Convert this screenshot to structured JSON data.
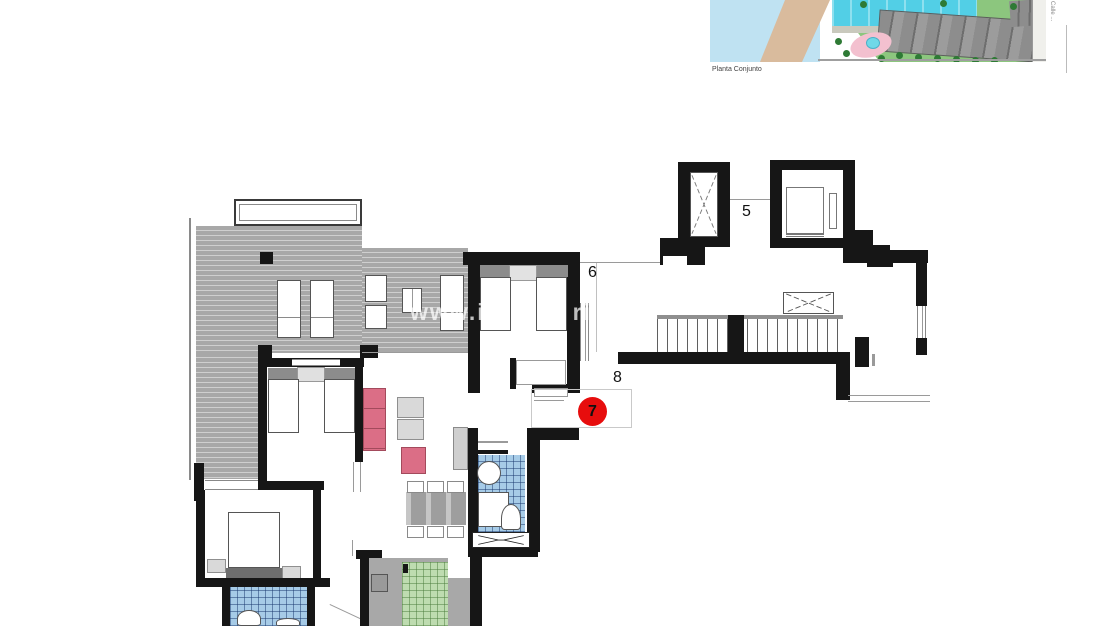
{
  "labels": {
    "unit5": "5",
    "unit6": "6",
    "unit8": "8",
    "badge": "7"
  },
  "watermark": "www.iw        ri",
  "site_plan": {
    "caption": "Planta Conjunto",
    "street": "Calle ..."
  },
  "colors": {
    "wall": "#161616",
    "line": "#9a9a9a",
    "badge": "#e70d0d",
    "pink": "#db6e86",
    "pinkdark": "#a34a5c",
    "headboard": "#8c8c8c",
    "terrace": "#a8a8a8",
    "terraceline": "#cfcfcf",
    "blue": "#a6cbe7",
    "blueline": "rgba(25,55,110,0.5)",
    "green": "#bedcb0",
    "greenline": "rgba(75,125,60,0.5)",
    "counter": "#a8a8a8",
    "sea": "#bfe2f2",
    "sand": "#d9bb9d",
    "grass": "#8cc67e",
    "pool": "#52cfe6",
    "bldg": "#8d8d8d",
    "pinkarea": "#f3c0cf",
    "tree": "#2e7a35",
    "road": "#f0f0ec"
  }
}
